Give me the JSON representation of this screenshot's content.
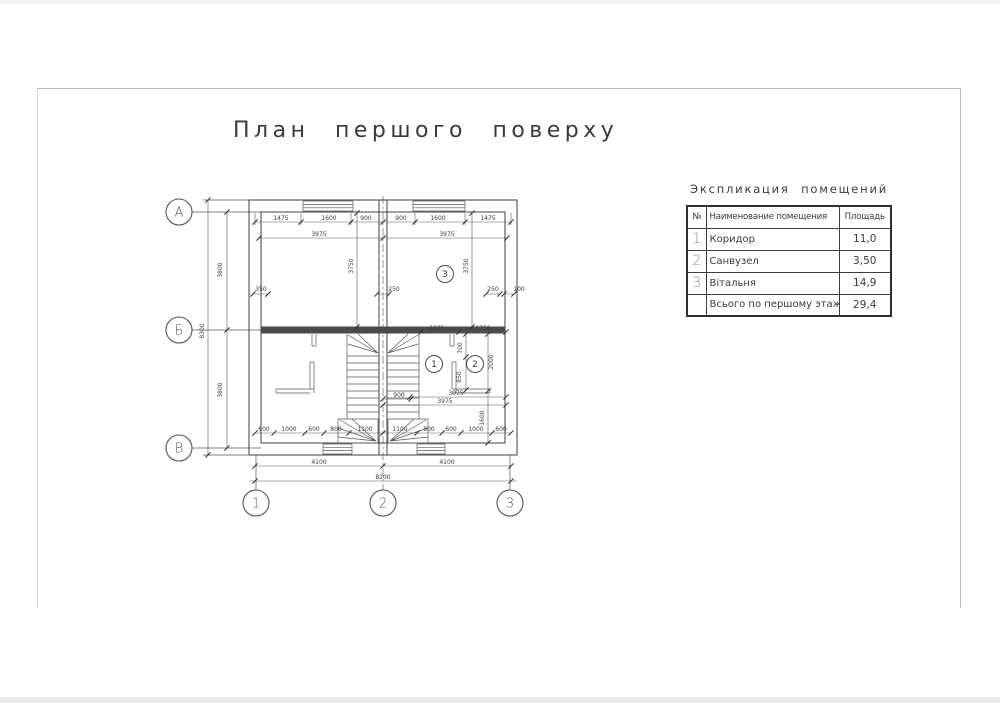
{
  "title": "План першого поверху",
  "explication": {
    "title": "Экспликация помещений",
    "columns": {
      "num": "№",
      "name": "Наименование помещения",
      "area": "Площадь"
    },
    "rows": [
      {
        "num": "1",
        "name": "Коридор",
        "area": "11,0"
      },
      {
        "num": "2",
        "name": "Санвузел",
        "area": "3,50"
      },
      {
        "num": "3",
        "name": "Вітальня",
        "area": "14,9"
      }
    ],
    "total_row": {
      "num": "",
      "name": "Всього по першому этажу",
      "area": "29,4"
    }
  },
  "plan": {
    "row_axes": [
      {
        "label": "А",
        "x": 179,
        "y": 212
      },
      {
        "label": "Б",
        "x": 179,
        "y": 330
      },
      {
        "label": "В",
        "x": 179,
        "y": 448
      }
    ],
    "col_axes": [
      {
        "label": "1",
        "x": 256,
        "y": 503
      },
      {
        "label": "2",
        "x": 383,
        "y": 503
      },
      {
        "label": "3",
        "x": 510,
        "y": 503
      }
    ],
    "rooms": [
      {
        "label": "1",
        "x": 434,
        "y": 364
      },
      {
        "label": "2",
        "x": 475,
        "y": 364
      },
      {
        "label": "3",
        "x": 445,
        "y": 274
      }
    ],
    "dims": [
      {
        "t": "1475",
        "x": 281,
        "y": 220
      },
      {
        "t": "1600",
        "x": 329,
        "y": 220
      },
      {
        "t": "900",
        "x": 366,
        "y": 220
      },
      {
        "t": "900",
        "x": 401,
        "y": 220
      },
      {
        "t": "1600",
        "x": 438,
        "y": 220
      },
      {
        "t": "1475",
        "x": 488,
        "y": 220
      },
      {
        "t": "3975",
        "x": 319,
        "y": 236
      },
      {
        "t": "3975",
        "x": 447,
        "y": 236
      },
      {
        "t": "3800",
        "x": 222,
        "y": 270,
        "r": -90
      },
      {
        "t": "3800",
        "x": 222,
        "y": 390,
        "r": -90
      },
      {
        "t": "8300",
        "x": 204,
        "y": 331,
        "r": -90
      },
      {
        "t": "3750",
        "x": 353,
        "y": 266,
        "r": -90
      },
      {
        "t": "3750",
        "x": 468,
        "y": 266,
        "r": -90
      },
      {
        "t": "350",
        "x": 261,
        "y": 291
      },
      {
        "t": "250",
        "x": 394,
        "y": 291
      },
      {
        "t": "250",
        "x": 493,
        "y": 291
      },
      {
        "t": "100",
        "x": 519,
        "y": 291
      },
      {
        "t": "1225",
        "x": 437,
        "y": 330
      },
      {
        "t": "1750",
        "x": 483,
        "y": 330
      },
      {
        "t": "700",
        "x": 462,
        "y": 348,
        "r": -90
      },
      {
        "t": "2000",
        "x": 493,
        "y": 362,
        "r": -90
      },
      {
        "t": "850",
        "x": 461,
        "y": 377,
        "r": -90
      },
      {
        "t": "3075",
        "x": 456,
        "y": 395
      },
      {
        "t": "3975",
        "x": 445,
        "y": 403
      },
      {
        "t": "900",
        "x": 399,
        "y": 397
      },
      {
        "t": "1600",
        "x": 484,
        "y": 418,
        "r": -90
      },
      {
        "t": "600",
        "x": 264,
        "y": 431
      },
      {
        "t": "1000",
        "x": 289,
        "y": 431
      },
      {
        "t": "600",
        "x": 314,
        "y": 431
      },
      {
        "t": "800",
        "x": 336,
        "y": 431
      },
      {
        "t": "1100",
        "x": 365,
        "y": 431
      },
      {
        "t": "1100",
        "x": 400,
        "y": 431
      },
      {
        "t": "800",
        "x": 429,
        "y": 431
      },
      {
        "t": "600",
        "x": 451,
        "y": 431
      },
      {
        "t": "1000",
        "x": 476,
        "y": 431
      },
      {
        "t": "600",
        "x": 501,
        "y": 431
      },
      {
        "t": "4100",
        "x": 319,
        "y": 464
      },
      {
        "t": "4100",
        "x": 447,
        "y": 464
      },
      {
        "t": "8200",
        "x": 383,
        "y": 479
      }
    ]
  },
  "colors": {
    "line": "#3f3f3f",
    "wall": "#4a4a4a",
    "text": "#3a3a3a",
    "muted": "#8c8c8c",
    "frame": "#b8b8b8",
    "paper": "#ffffff"
  }
}
